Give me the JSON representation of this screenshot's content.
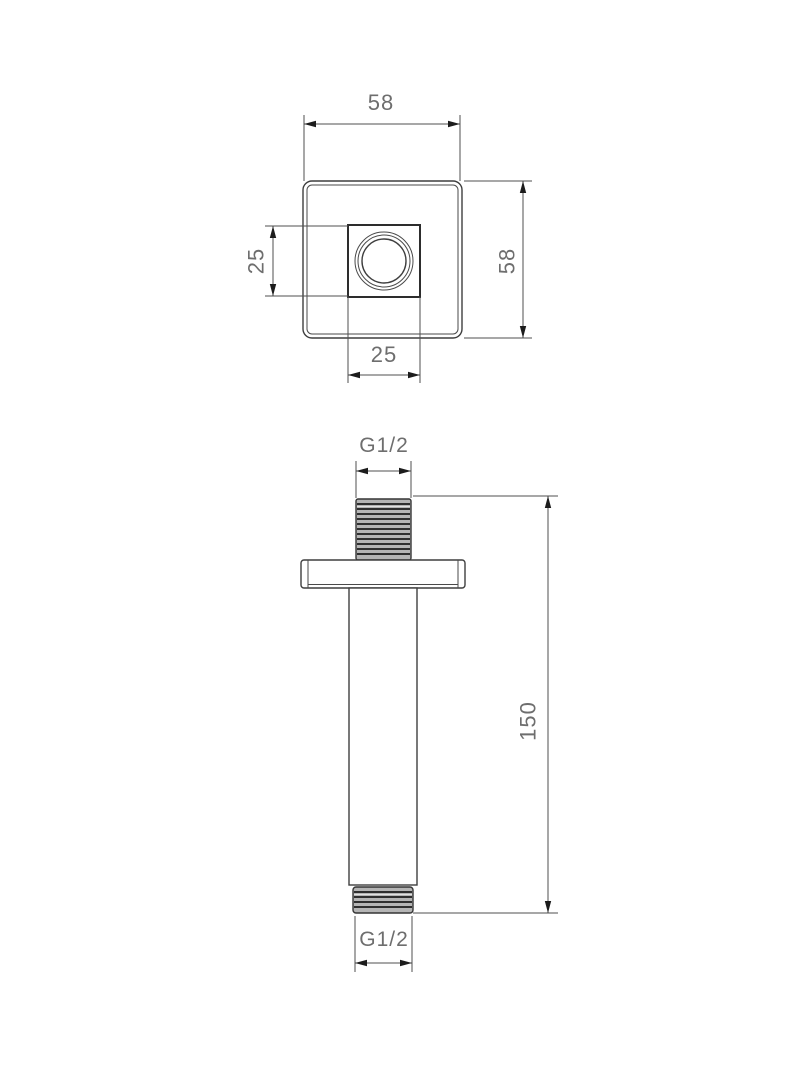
{
  "drawing": {
    "type": "technical-drawing",
    "part": "square-ceiling-shower-arm",
    "views": {
      "top_view_name": "plan-view-of-ceiling-plate",
      "front_view_name": "elevation-view-of-arm"
    },
    "dims": {
      "plate_width": "58",
      "plate_height": "58",
      "boss_height": "25",
      "boss_width": "25",
      "arm_length": "150",
      "thread_top": "G1/2",
      "thread_bottom": "G1/2"
    },
    "colors": {
      "background": "#ffffff",
      "object_line": "#3f3f3f",
      "dimension_line": "#4f4f4f",
      "text": "#6e6e6e",
      "thread_fill": "#b5b5b5"
    }
  }
}
